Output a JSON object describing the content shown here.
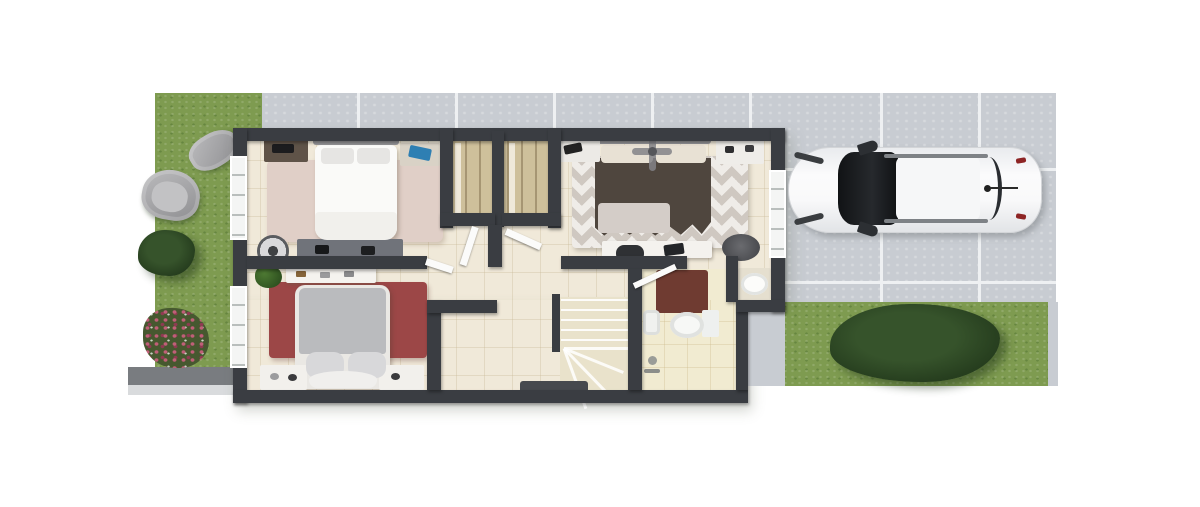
{
  "scene": {
    "type": "3d-floor-plan-render",
    "view": "top-down",
    "outdoor": {
      "front_garden": {
        "name": "front garden",
        "items": [
          "lawn",
          "lounge armchair",
          "armchair",
          "dark shrub",
          "pink flower bed",
          "gray walkway"
        ]
      },
      "patio": {
        "name": "tiled patio strip",
        "position": "top"
      },
      "driveway": {
        "name": "tiled driveway",
        "position": "right",
        "vehicle": "white sedan parked, top view, facing left"
      },
      "rear_lawn": {
        "name": "rear lawn",
        "items": [
          "large dark shrub"
        ],
        "position": "bottom-right"
      }
    },
    "house": {
      "name": "upper floor plan",
      "rooms": [
        {
          "name": "bedroom-1",
          "position": "top-left",
          "furniture": [
            "double bed with white duvet and gray headboard",
            "dark nightstand with accessories",
            "light nightstand with blue book",
            "round fan",
            "dresser with accessories",
            "pink area rug"
          ]
        },
        {
          "name": "bedroom-2",
          "position": "bottom-left",
          "furniture": [
            "double bed with gray duvet and curved footboard",
            "two white nightstands",
            "vanity with cosmetics",
            "potted plant",
            "red area rug"
          ]
        },
        {
          "name": "master-bedroom",
          "position": "top-right",
          "furniture": [
            "double bed with dark brown duvet and cream pillows",
            "ceiling fan",
            "two white nightstands",
            "desk with laptop and black chair",
            "round dark ottoman",
            "chevron-pattern area rug"
          ]
        },
        {
          "name": "closets",
          "position": "top-center",
          "furniture": [
            "two built-in wardrobes with tan shelving",
            "open white doors"
          ]
        },
        {
          "name": "bathroom",
          "position": "bottom-right",
          "furniture": [
            "toilet with tank",
            "bidet",
            "oval washbasin on counter",
            "dark red rug",
            "shower fittings",
            "open door"
          ]
        },
        {
          "name": "hallway-landing",
          "position": "center",
          "furniture": [
            "dark doormat"
          ]
        },
        {
          "name": "staircase",
          "position": "bottom-center",
          "furniture": [
            "straight flight",
            "winder turn",
            "dark handrail"
          ]
        }
      ]
    }
  },
  "colors": {
    "grass": "#7e9b50",
    "tile": "#c8ccd2",
    "grout": "#eef0f2",
    "walkway": "#797c80",
    "walkwayEdge": "#d9dbdd",
    "flowers": "#c05f78",
    "wall": "#3a3d42",
    "floor": "#f0e9d9",
    "bathFloor": "#f1ebd1",
    "stairFloor": "#e9e2cb",
    "closet": "#cec09b",
    "rug1": "#e0cfc7",
    "rug2": "#9c4747",
    "bathRug": "#6f3b31",
    "rugMasterA": "#cfc8c1",
    "rugMasterB": "#efece8",
    "bedWhite": "#fafaf8",
    "headboard": "#97979a",
    "pillowLight": "#e6e5e3",
    "masterDuvet": "#4f463e",
    "masterPillow": "#e8e1d4",
    "masterBlanket": "#d4cdc8",
    "bed2Duvet": "#babbbe",
    "bed2Frame": "#eae8e4",
    "nightstandLight": "#d9d2c6",
    "nightstandDark": "#5f5348",
    "dresser": "#70737a",
    "accentBlue": "#2e7fb3",
    "toiletWhite": "#f7f8f6",
    "ottoman": "#4c4d51",
    "deskChair": "#2f3134",
    "mat": "#46494e",
    "doorLeaf": "#fbfbfa",
    "windowFrame": "#f4f5f4",
    "windowGlass": "#b9bebc",
    "carBody": "#f4f5f6",
    "carGlass": "#17191c"
  }
}
